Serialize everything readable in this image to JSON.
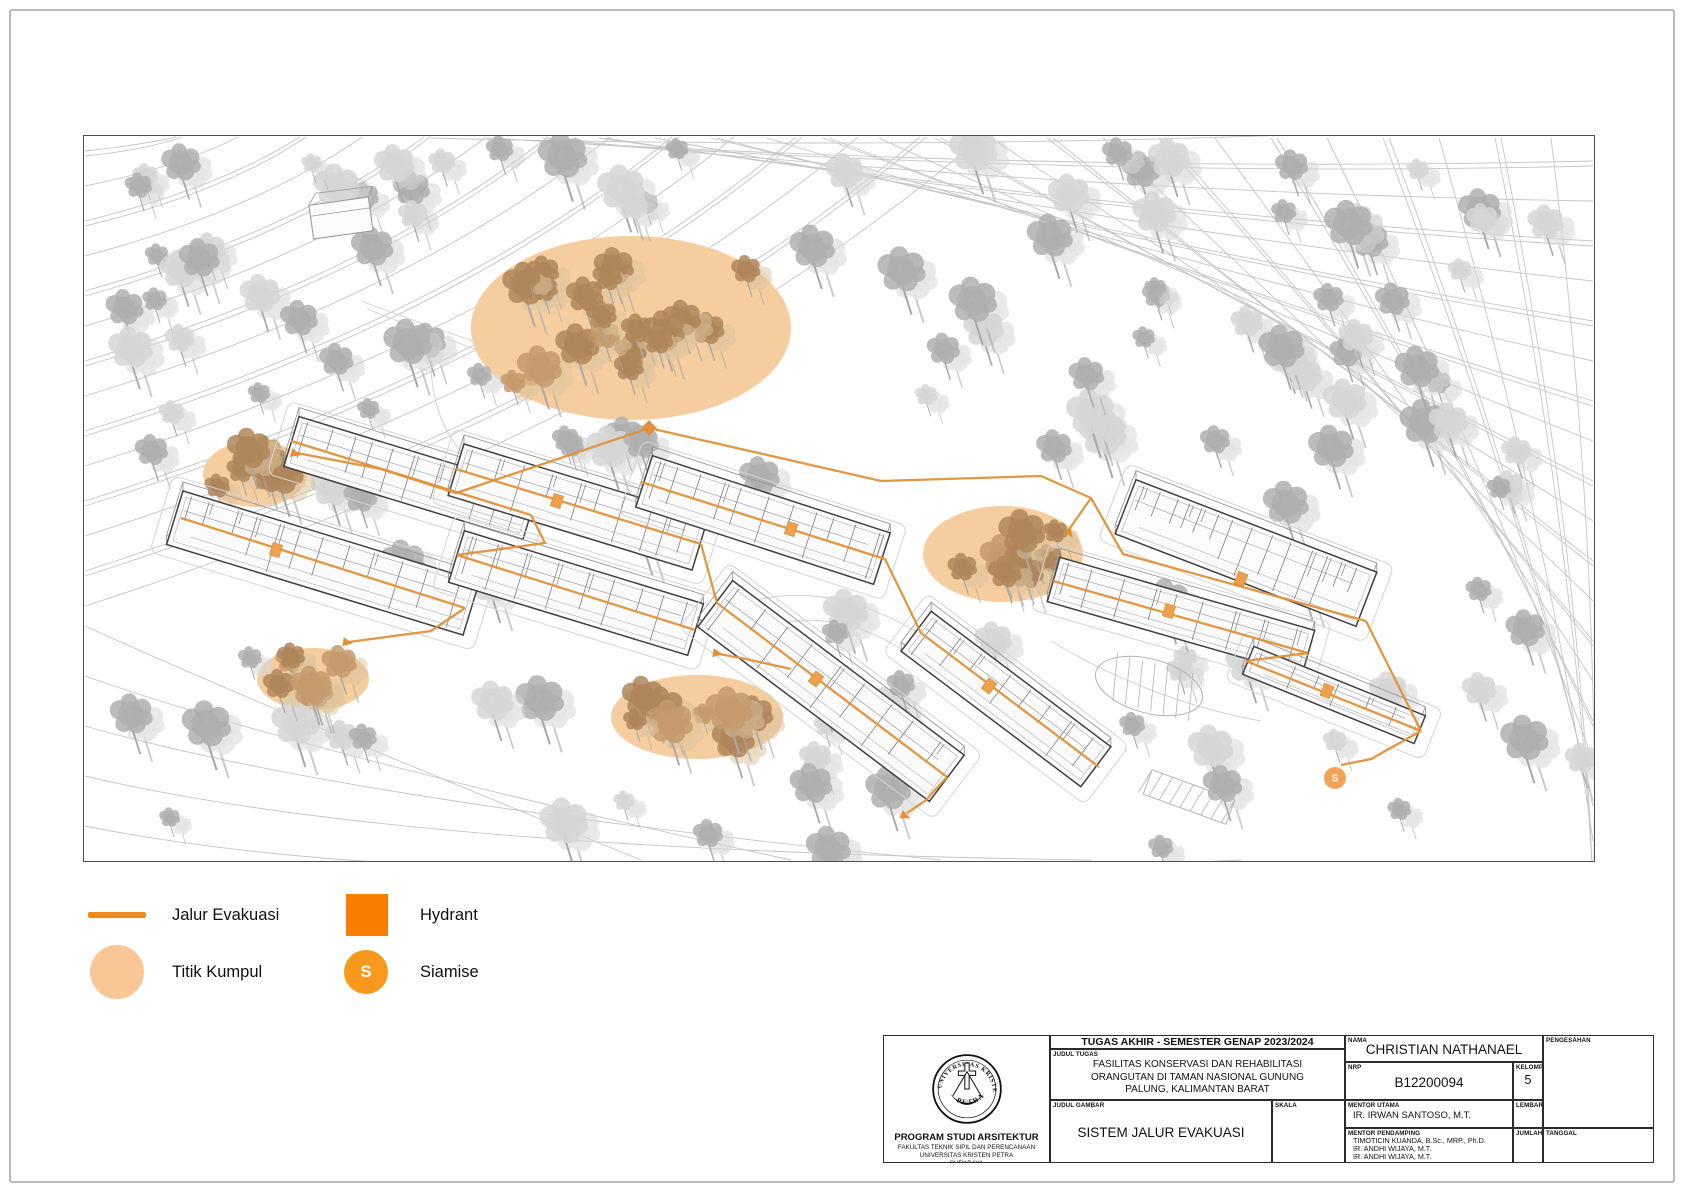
{
  "legend": {
    "items": [
      {
        "id": "jalur-evakuasi",
        "label": "Jalur Evakuasi",
        "swatch": "line"
      },
      {
        "id": "hydrant",
        "label": "Hydrant",
        "swatch": "square"
      },
      {
        "id": "titik-kumpul",
        "label": "Titik Kumpul",
        "swatch": "circle"
      },
      {
        "id": "siamise",
        "label": "Siamise",
        "swatch": "circle-s",
        "swatch_text": "S"
      }
    ],
    "colors": {
      "line": "#EF8A1D",
      "square": "#FB7D00",
      "circle": "#F9C795",
      "circle_s": "#F8981D"
    }
  },
  "title_block": {
    "header": "TUGAS AKHIR - SEMESTER GENAP 2023/2024",
    "labels": {
      "judul_tugas": "JUDUL TUGAS",
      "judul_gambar": "JUDUL GAMBAR",
      "skala": "SKALA",
      "nama": "NAMA",
      "nrp": "NRP",
      "kelompok": "KELOMPOK",
      "mentor_utama": "MENTOR UTAMA",
      "mentor_pendamping": "MENTOR PENDAMPING",
      "lembar": "LEMBAR",
      "jumlah": "JUMLAH",
      "tanggal": "TANGGAL",
      "pengesahan": "PENGESAHAN"
    },
    "judul_tugas_lines": [
      "FASILITAS KONSERVASI DAN REHABILITASI",
      "ORANGUTAN DI TAMAN NASIONAL GUNUNG",
      "PALUNG, KALIMANTAN BARAT"
    ],
    "judul_gambar_value": "SISTEM JALUR EVAKUASI",
    "nama_value": "CHRISTIAN NATHANAEL",
    "nrp_value": "B12200094",
    "kelompok_value": "5",
    "mentor_utama_value": "IR. IRWAN SANTOSO, M.T.",
    "mentor_pendamping_values": [
      "TIMOTICIN KUANDA, B.Sc., MRP., Ph.D.",
      "IR. ANDHI WIJAYA, M.T.",
      "IR. ANDHI WIJAYA, M.T."
    ],
    "institution": {
      "line1": "PROGRAM STUDI ARSITEKTUR",
      "line2": "FAKULTAS TEKNIK SIPIL DAN PERENCANAAN",
      "line3": "UNIVERSITAS KRISTEN PETRA",
      "line4": "SURABAYA"
    },
    "logo": {
      "top_text": "UNIVERSITAS KRISTEN",
      "bottom_text": "PETRA"
    }
  },
  "site_plan": {
    "frame": {
      "x": 83,
      "y": 135,
      "w": 1510,
      "h": 725
    },
    "colors": {
      "route": "#E0913A",
      "assembly": "#F6CD9F",
      "door": "#EFA04C",
      "siamise": "#F2A356",
      "tree": "#AFAFAF",
      "tree_light": "#D6D6D6",
      "tree_brown": "#AF855A",
      "tree_brown_light": "#DCC49D",
      "contour": "#C5C5C5",
      "wall": "#3F3F3F",
      "partition": "#6E6E6E",
      "apron": "#D4D4D4"
    },
    "assembly_points": [
      {
        "cx": 630,
        "cy": 327,
        "rx": 160,
        "ry": 92
      },
      {
        "cx": 254,
        "cy": 473,
        "rx": 52,
        "ry": 33
      },
      {
        "cx": 312,
        "cy": 678,
        "rx": 56,
        "ry": 31
      },
      {
        "cx": 696,
        "cy": 716,
        "rx": 86,
        "ry": 42
      },
      {
        "cx": 1002,
        "cy": 553,
        "rx": 80,
        "ry": 48
      }
    ],
    "siamise_marker": {
      "x": 1334,
      "y": 777,
      "r": 11,
      "label": "S"
    },
    "shed": {
      "x": 340,
      "y": 217
    },
    "buildings": [
      {
        "cx": 322,
        "cy": 562,
        "len": 310,
        "wid": 56,
        "ang": 17,
        "step": 24
      },
      {
        "cx": 410,
        "cy": 477,
        "len": 250,
        "wid": 52,
        "ang": 17,
        "step": 22
      },
      {
        "cx": 577,
        "cy": 506,
        "len": 255,
        "wid": 54,
        "ang": 17,
        "step": 22
      },
      {
        "cx": 575,
        "cy": 592,
        "len": 250,
        "wid": 54,
        "ang": 17,
        "step": 24
      },
      {
        "cx": 762,
        "cy": 519,
        "len": 250,
        "wid": 54,
        "ang": 18,
        "step": 22
      },
      {
        "cx": 830,
        "cy": 690,
        "len": 290,
        "wid": 58,
        "ang": 37,
        "step": 26
      },
      {
        "cx": 1005,
        "cy": 698,
        "len": 225,
        "wid": 50,
        "ang": 37,
        "step": 28
      },
      {
        "cx": 1245,
        "cy": 552,
        "len": 258,
        "wid": 58,
        "ang": 21,
        "step": 16
      },
      {
        "cx": 1180,
        "cy": 615,
        "len": 265,
        "wid": 46,
        "ang": 16,
        "step": 26
      },
      {
        "cx": 1333,
        "cy": 694,
        "len": 185,
        "wid": 30,
        "ang": 22,
        "step": 28
      }
    ],
    "routes": [
      [
        [
          648,
          427
        ],
        [
          545,
          462
        ],
        [
          455,
          492
        ],
        [
          380,
          468
        ],
        [
          296,
          452
        ]
      ],
      [
        [
          290,
          440
        ],
        [
          530,
          514
        ]
      ],
      [
        [
          455,
          468
        ],
        [
          700,
          543
        ]
      ],
      [
        [
          456,
          554
        ],
        [
          694,
          629
        ]
      ],
      [
        [
          180,
          517
        ],
        [
          464,
          607
        ]
      ],
      [
        [
          640,
          481
        ],
        [
          884,
          558
        ]
      ],
      [
        [
          716,
          602
        ],
        [
          946,
          776
        ]
      ],
      [
        [
          920,
          632
        ],
        [
          1098,
          766
        ]
      ],
      [
        [
          1090,
          497
        ],
        [
          1122,
          553
        ],
        [
          1365,
          620
        ]
      ],
      [
        [
          1052,
          580
        ],
        [
          1307,
          652
        ]
      ],
      [
        [
          1245,
          660
        ],
        [
          1420,
          730
        ]
      ],
      [
        [
          530,
          514
        ],
        [
          544,
          542
        ],
        [
          456,
          554
        ]
      ],
      [
        [
          700,
          543
        ],
        [
          716,
          602
        ]
      ],
      [
        [
          884,
          558
        ],
        [
          920,
          632
        ]
      ],
      [
        [
          464,
          607
        ],
        [
          430,
          630
        ],
        [
          348,
          641
        ]
      ],
      [
        [
          790,
          668
        ],
        [
          745,
          658
        ],
        [
          718,
          653
        ]
      ],
      [
        [
          946,
          776
        ],
        [
          924,
          800
        ],
        [
          906,
          812
        ]
      ],
      [
        [
          648,
          427
        ],
        [
          880,
          480
        ],
        [
          1040,
          475
        ],
        [
          1090,
          497
        ]
      ],
      [
        [
          1090,
          497
        ],
        [
          1069,
          527
        ]
      ],
      [
        [
          1307,
          652
        ],
        [
          1245,
          660
        ]
      ],
      [
        [
          1365,
          620
        ],
        [
          1395,
          680
        ],
        [
          1420,
          730
        ]
      ],
      [
        [
          1420,
          730
        ],
        [
          1370,
          758
        ],
        [
          1340,
          764
        ]
      ]
    ],
    "arrows": [
      {
        "x": 292,
        "y": 452,
        "ang": 195
      },
      {
        "x": 344,
        "y": 641,
        "ang": 190
      },
      {
        "x": 714,
        "y": 652,
        "ang": 190
      },
      {
        "x": 902,
        "y": 814,
        "ang": 205
      },
      {
        "x": 1067,
        "y": 530,
        "ang": 235
      }
    ],
    "entry_diamond": {
      "x": 648,
      "y": 427
    },
    "hydrant_doors": [
      {
        "x": 275,
        "y": 549,
        "ang": 17
      },
      {
        "x": 556,
        "y": 500,
        "ang": 17
      },
      {
        "x": 790,
        "y": 528,
        "ang": 18
      },
      {
        "x": 815,
        "y": 678,
        "ang": 37
      },
      {
        "x": 988,
        "y": 685,
        "ang": 37
      },
      {
        "x": 1240,
        "y": 578,
        "ang": 21
      },
      {
        "x": 1168,
        "y": 610,
        "ang": 16
      },
      {
        "x": 1326,
        "y": 690,
        "ang": 22
      }
    ],
    "hatches": [
      {
        "x": 503,
        "y": 562,
        "ang": 17
      },
      {
        "x": 987,
        "y": 700,
        "ang": 37
      }
    ],
    "parking": {
      "oval": {
        "cx": 1148,
        "cy": 685,
        "rx": 55,
        "ry": 27,
        "ang": 15
      },
      "strip": {
        "cx": 1188,
        "cy": 796,
        "len": 88,
        "wid": 26,
        "ang": 20,
        "slots": 8
      }
    }
  }
}
